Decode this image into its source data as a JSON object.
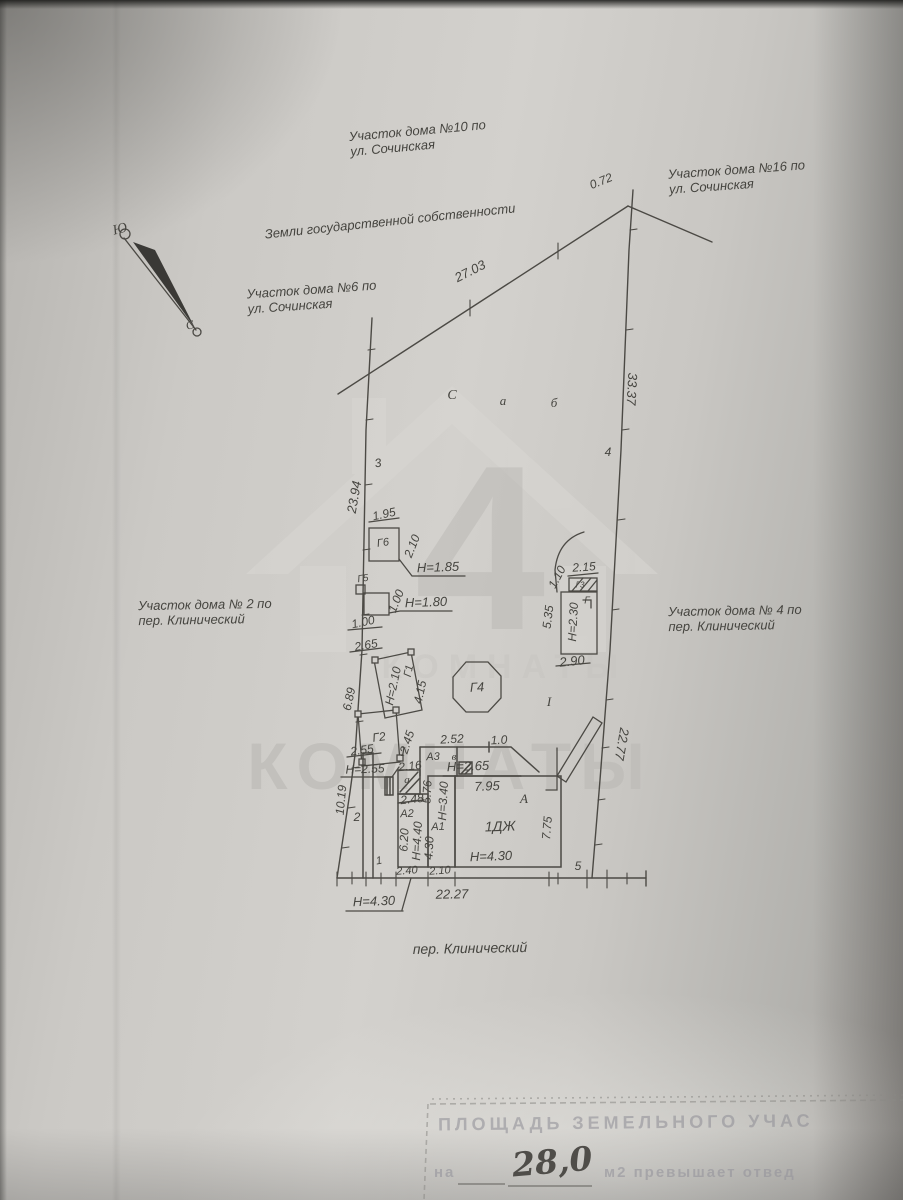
{
  "compass": {
    "south": "Ю",
    "north": "С"
  },
  "areas": {
    "parcel10_l1": "Участок дома №10 по",
    "parcel10_l2": "ул. Сочинская",
    "parcel16_l1": "Участок дома №16 по",
    "parcel16_l2": "ул. Сочинская",
    "parcel6_l1": "Участок дома №6 по",
    "parcel6_l2": "ул. Сочинская",
    "parcel2_l1": "Участок дома № 2 по",
    "parcel2_l2": "пер. Клинический",
    "parcel4_l1": "Участок дома № 4 по",
    "parcel4_l2": "пер. Клинический",
    "state_land": "Земли государственной собственности",
    "street": "пер. Клинический"
  },
  "boundary_dims": {
    "top_small": "0.72",
    "top": "27.03",
    "right_upper": "33.37",
    "right_lower": "22.77",
    "left_upper": "23.94",
    "left_lower": "10.19",
    "front": "22.27",
    "inner_right": "5.35",
    "inner_right_small": "1.10"
  },
  "point_marks": {
    "c": "С",
    "a": "а",
    "b": "б",
    "n1": "1",
    "n2": "2",
    "n3": "3",
    "n4": "4",
    "n5": "5",
    "i_left": "I",
    "i_right": "I"
  },
  "structures": {
    "g6": {
      "name": "Г6",
      "width": "1.95",
      "depth": "2.10",
      "height": "Н=1.85"
    },
    "g5": {
      "name": "Г5",
      "width": "1.00",
      "depth": "1.00",
      "height": "Н=1.80"
    },
    "g1": {
      "name": "Г1",
      "top": "2.65",
      "height": "Н=2.10",
      "length": "4.15",
      "side": "6.89"
    },
    "g2": {
      "name": "Г2",
      "length": "2.45",
      "width": "2.55",
      "height": "Н=2.55"
    },
    "g4": {
      "name": "Г4"
    },
    "g3": {
      "name": "Г3",
      "width": "2.15"
    },
    "g_right": {
      "name": "Г",
      "height": "Н=2.30",
      "width": "2.90"
    },
    "a3": {
      "name": "А3",
      "room": "в",
      "top1": "2.52",
      "top2": "1.0",
      "width": "2.16"
    },
    "a_shed": {
      "name": "а",
      "width": "2.48"
    },
    "a2": {
      "name": "А2",
      "length": "6.20",
      "height": "Н=4.40",
      "width": "2.40"
    },
    "a1": {
      "name": "А1",
      "length": "4.30",
      "height": "Н=3.40",
      "side": "5.76",
      "width": "2.10"
    },
    "main": {
      "name": "1ДЖ",
      "block": "А",
      "height": "Н=4.30",
      "top": "7.95",
      "side": "7.75",
      "top_height": "Н=2.65",
      "street_height": "Н=4.30"
    }
  },
  "stamp": {
    "line1": "ПЛОЩАДЬ ЗЕМЕЛЬНОГО УЧАС",
    "prefix": "на",
    "value": "28,0",
    "suffix": "м2 превышает отвед"
  },
  "watermark": {
    "digit": "4",
    "brand": "КОМНАТЫ",
    "brand_faint": "КОМНАТЫ"
  }
}
